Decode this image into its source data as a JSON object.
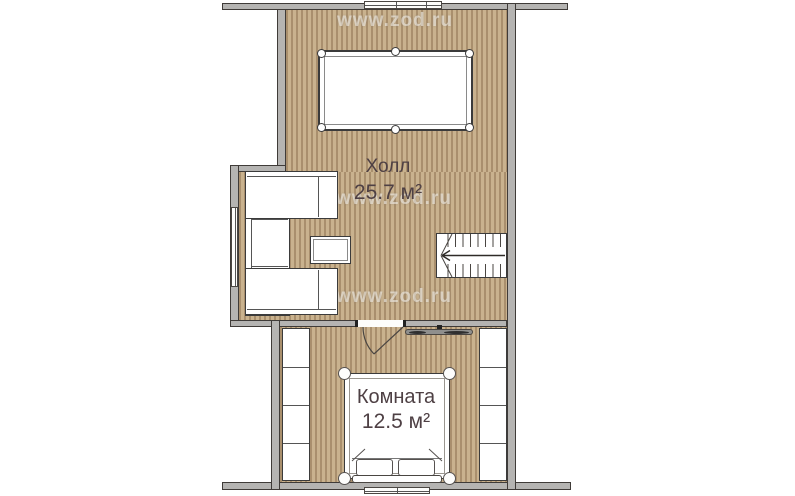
{
  "watermark": {
    "text": "www.zod.ru"
  },
  "rooms": {
    "hall": {
      "name": "Холл",
      "area": "25.7 м²"
    },
    "bedroom": {
      "name": "Комната",
      "area": "12.5 м²"
    }
  },
  "colors": {
    "floor_base": "#c9b28e",
    "floor_stripe": "#a98f6d",
    "wall_fill": "#b5b4b2",
    "wall_outline": "#3f3b38",
    "label_text": "#4e4044",
    "watermark_color": "rgba(250,247,243,0.55)"
  }
}
